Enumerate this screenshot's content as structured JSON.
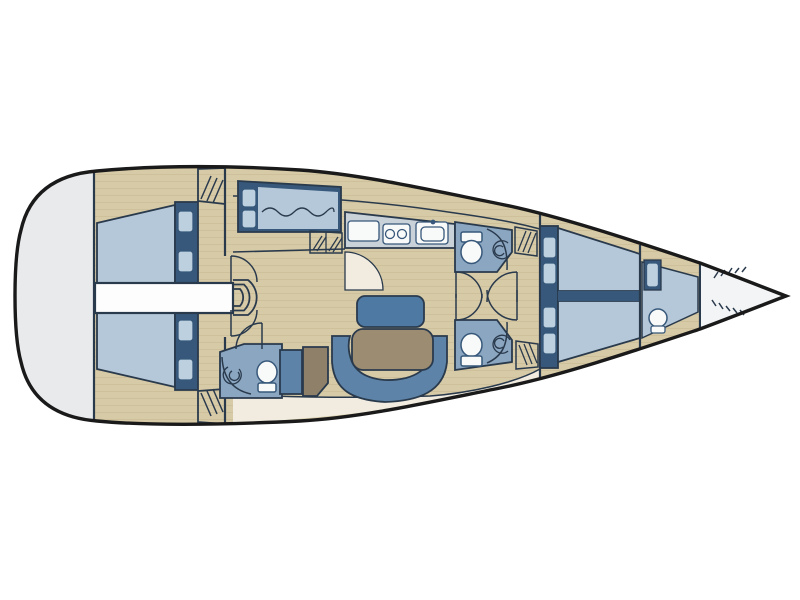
{
  "figure": {
    "type": "diagram",
    "subject": "sailing-yacht interior floor plan, top view, bow pointing right",
    "canvas": {
      "width": 800,
      "height": 600
    },
    "visible_text": []
  },
  "colors": {
    "page_bg": "#ffffff",
    "hull_line": "#1a1a1a",
    "line": "#2a3a4d",
    "deck": "#d7caa6",
    "plank": "#c3b48d",
    "stern_deck": "#e9eaec",
    "bow_locker": "#f3f4f5",
    "cream": "#f1ecdf",
    "navy": "#37587a",
    "bed": "#b5c8da",
    "pillow": "#bdd0e0",
    "bath": "#8ba6c0",
    "sofa": "#5d84a8",
    "bench": "#4e79a2",
    "table": "#9c8c72",
    "seat": "#8e8069",
    "counter": "#c9d1d9",
    "fixture": "#f8f9f9"
  },
  "elements": {
    "rooms": [
      "stern-cockpit",
      "aft-cabin-upper",
      "aft-cabin-lower",
      "engine-walkway",
      "companionway-steps",
      "single-berth-upper",
      "galley",
      "saloon",
      "head-upper-mid",
      "head-lower-mid",
      "head-lower-aft",
      "forward-cabin",
      "forepeak-cabin",
      "anchor-locker"
    ],
    "furniture": [
      "double-berth",
      "pillows",
      "wardrobe-hatch",
      "stove-burners",
      "sink",
      "fridge-counter",
      "toilet",
      "shower-drain",
      "dining-table",
      "u-sofa",
      "bench-seat",
      "stool",
      "door-swing"
    ]
  }
}
